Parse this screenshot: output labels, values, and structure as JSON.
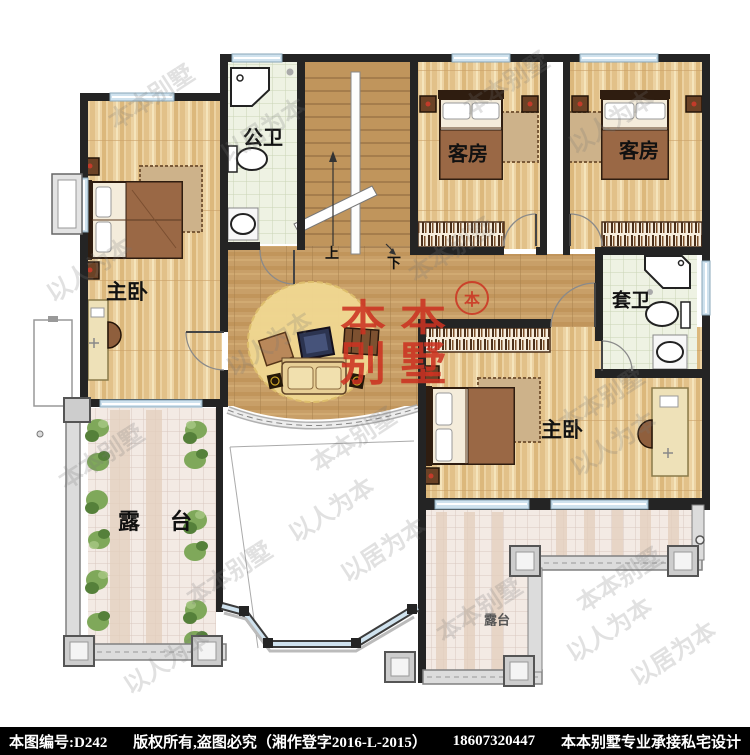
{
  "plan": {
    "rooms": [
      {
        "id": "master-bedroom-left",
        "label": "主卧"
      },
      {
        "id": "public-bathroom",
        "label": "公卫"
      },
      {
        "id": "guest-room-1",
        "label": "客房"
      },
      {
        "id": "guest-room-2",
        "label": "客房"
      },
      {
        "id": "ensuite-bathroom",
        "label": "套卫"
      },
      {
        "id": "master-bedroom-right",
        "label": "主卧"
      },
      {
        "id": "terrace-left",
        "label": "露台"
      },
      {
        "id": "terrace-right",
        "label": "露台"
      }
    ],
    "stairs": {
      "up_label": "上",
      "down_label": "下"
    }
  },
  "watermark": {
    "brand": "本本别墅",
    "slogan_people": "以人为本",
    "slogan_living": "以居为本",
    "logo_line1": "本本",
    "logo_line2": "别墅",
    "seal_char": "本",
    "logo_color": "#cc3322"
  },
  "footer": {
    "serial": "本图编号:D242",
    "copyright": "版权所有,盗图必究（湘作登字2016-L-2015）",
    "phone": "18607320447",
    "tagline": "本本别墅专业承接私宅设计",
    "background": "#000000",
    "text_color": "#ffffff"
  },
  "colors": {
    "wall": "#242424",
    "window": "#cfe2ee",
    "wood_room": "#ecd2a2",
    "wood_hall": "#c89f68",
    "bath_tile": "#eef2e3",
    "terrace_tile": "#f3eae4"
  }
}
